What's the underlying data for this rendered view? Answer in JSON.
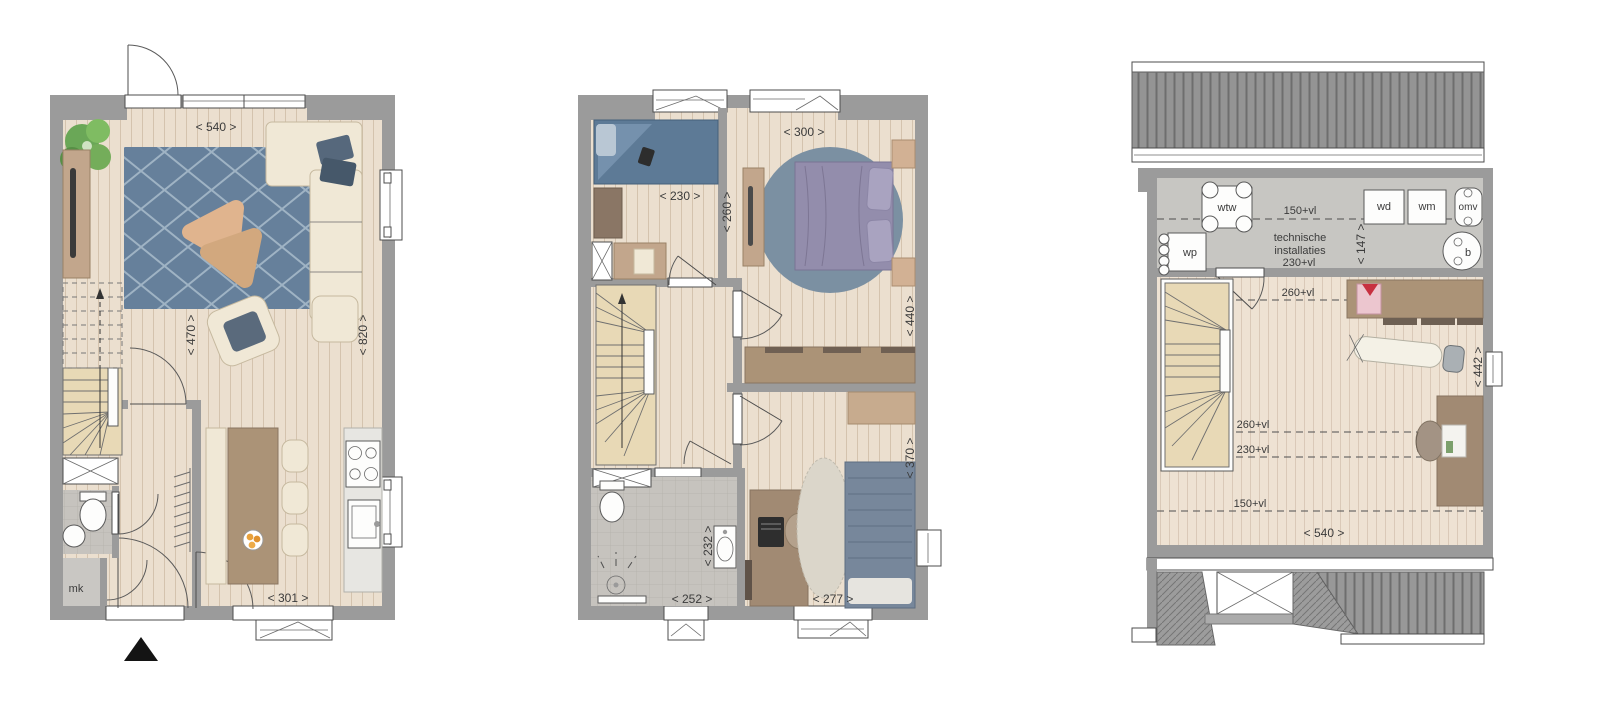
{
  "ground_floor": {
    "dim_top_width": "< 540 >",
    "dim_living_depth": "< 470 >",
    "dim_right_depth": "< 820 >",
    "dim_kitchen_width": "< 301 >",
    "label_meter_cupboard": "mk"
  },
  "first_floor": {
    "dim_bedroom1_width": "< 230 >",
    "dim_landing_depth": "< 260 >",
    "dim_bedroom2_width": "< 300 >",
    "dim_bedroom2_depth": "< 440 >",
    "dim_bathroom_depth": "< 232 >",
    "dim_bathroom_width": "< 252 >",
    "dim_bedroom3_width": "< 277 >",
    "dim_bedroom3_depth": "< 370 >"
  },
  "attic": {
    "label_wtw": "wtw",
    "label_wp": "wp",
    "label_wd": "wd",
    "label_wm": "wm",
    "label_omv": "omv",
    "label_boiler": "b",
    "label_tech_line1": "technische",
    "label_tech_line2": "installaties",
    "height_line_150_top": "150+vl",
    "dim_tech_depth": "< 147 >",
    "height_line_230_top": "230+vl",
    "height_line_260_top": "260+vl",
    "height_line_260_mid": "260+vl",
    "height_line_230_mid": "230+vl",
    "height_line_150_low": "150+vl",
    "dim_attic_depth": "< 442 >",
    "dim_attic_width": "< 540 >"
  }
}
